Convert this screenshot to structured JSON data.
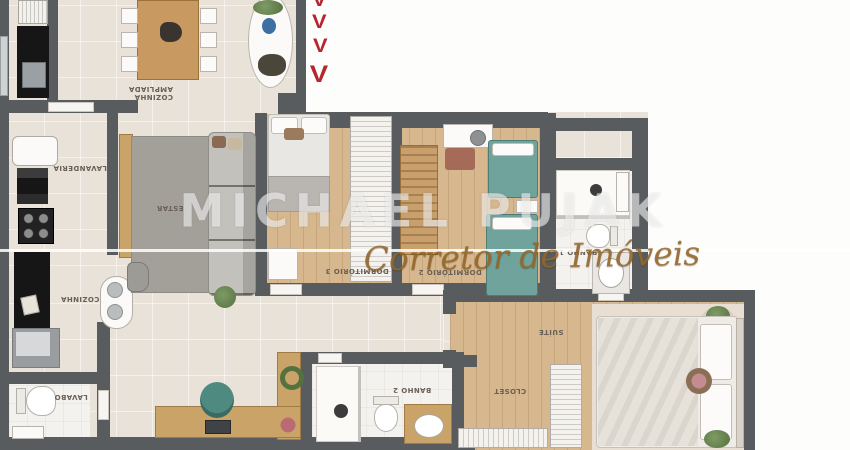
{
  "watermark": {
    "name": "MICHAEL PUJAK",
    "tagline": "Corretor de Imóveis"
  },
  "marks": {
    "items": [
      "V",
      "V",
      "V",
      "V"
    ]
  },
  "rooms": {
    "cozinha_ampliada": {
      "line1": "COZINHA",
      "line2": "AMPLIADA"
    },
    "lavanderia": "LAVANDERIA",
    "cozinha": "COZINHA",
    "estar": "ESTAR",
    "dormitorio3": "DORMITÓRIO 3",
    "dormitorio2": "DORMITÓRIO 2",
    "banho1": "BANHO 1",
    "suite": "SUÍTE",
    "closet": "CLOSET",
    "banho2": "BANHO 2",
    "lavabo": "LAVABO"
  },
  "colors": {
    "wall": "#585c5f",
    "floor_tile": "#e9e2d8",
    "floor_wood": "#d6b78e",
    "bath_floor": "#f4f2ee",
    "suite_rug": "#e9ded2",
    "accent_red": "#b5262e",
    "teal_bed": "#6fa39b",
    "rug_gray": "#a3a09a",
    "counter_black": "#161616",
    "label_text": "#6a6057",
    "watermark_white": "rgba(255,255,255,0.55)",
    "watermark_gold": "rgba(150,105,45,0.85)"
  }
}
